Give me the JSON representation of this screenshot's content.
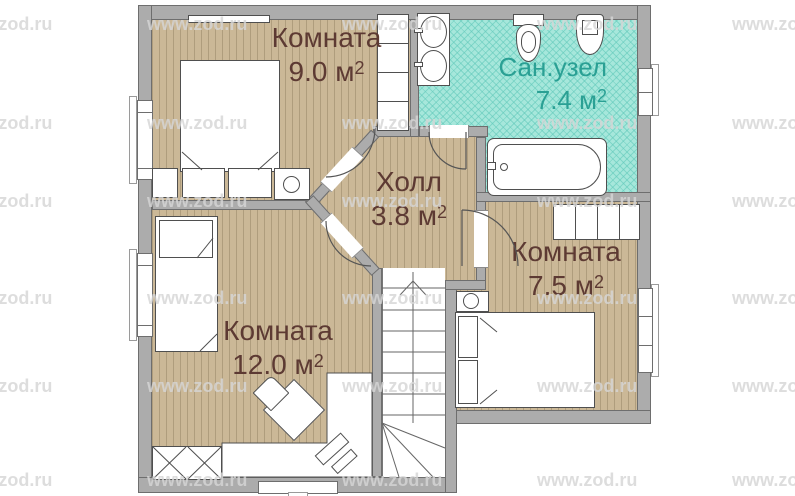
{
  "rooms": [
    {
      "id": "room-9",
      "name": "Комната",
      "area": "9.0 м",
      "exp": "2"
    },
    {
      "id": "bathroom",
      "name": "Сан.узел",
      "area": "7.4 м",
      "exp": "2"
    },
    {
      "id": "hall",
      "name": "Холл",
      "area": "3.8 м",
      "exp": "2"
    },
    {
      "id": "room-7-5",
      "name": "Комната",
      "area": "7.5 м",
      "exp": "2"
    },
    {
      "id": "room-12",
      "name": "Комната",
      "area": "12.0 м",
      "exp": "2"
    }
  ],
  "watermark": {
    "text": "www.zod.ru"
  },
  "colors": {
    "floor": "#cbb897",
    "floor_stripe": "#af9d7d",
    "bathroom_fill": "#a6e7db",
    "bathroom_lattice": "#5fc8b9",
    "wall": "#acacac",
    "wall_outline": "#6e6e6e",
    "room_label": "#5d3a33",
    "bathroom_label": "#2aa094",
    "watermark": "#d5d5d5"
  }
}
